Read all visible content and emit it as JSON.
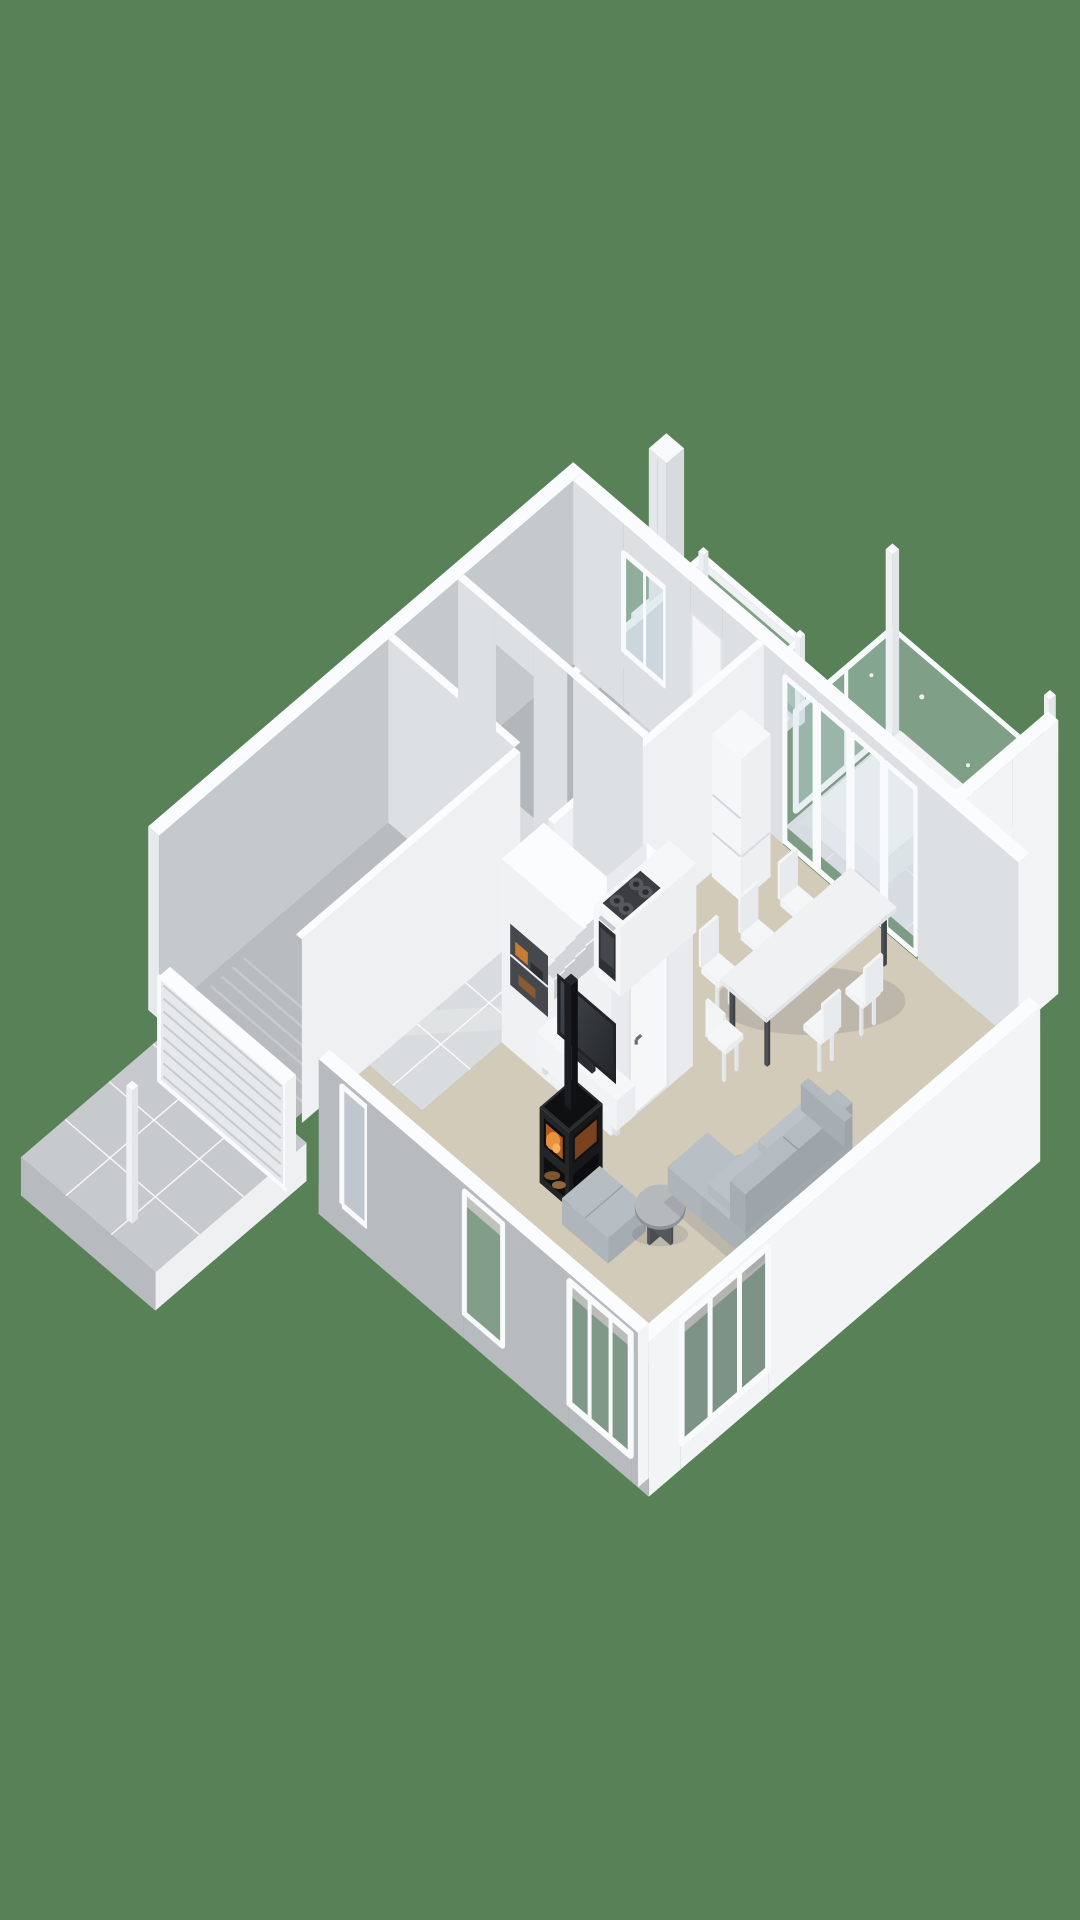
{
  "scene": {
    "type": "isometric-3d-floorplan-render",
    "background_color": "#588157",
    "colors": {
      "wallTop": "#fbfcfd",
      "ext": "#f2f4f6",
      "extSoft": "#eef0f2",
      "faceL": "#e7eaec",
      "grayExt": "#b7bbbf",
      "innerGray": "#c4c9ce",
      "innerLight": "#dde0e3",
      "innerMid": "#cfd3d7",
      "garageFloor": "#b8bcc1",
      "bedroomFloor": "#b2b7bc",
      "tile": "#d9dcde",
      "grout": "rgba(255,255,255,0.85)",
      "carpet": "#d2cbba",
      "terraceFloor": "#dcdee0",
      "driveFloor": "#c7cacd",
      "glass": "#c9dbe3",
      "frame": "#f8fafb",
      "blockL": "#eff1f3",
      "blockF": "#e8eaed",
      "white": "#f4f6f7",
      "whiteF": "#edeff1",
      "tread": "#d3d6d9",
      "riser": "#c5c9cc",
      "dark": "#2e3134",
      "steel": "#c3c8cc",
      "stoveBody": "#1c1e20",
      "stoveSide": "#232527",
      "fire": "#e8913f",
      "fireDeep": "#b35a22",
      "wood": "#8a5a33",
      "sofa": "#a9b1b7",
      "sofaTop": "#b8bfc5",
      "cushion": "#bcc3c8",
      "tvDark": "#212427",
      "screen": "#363a3e",
      "tableTop": "#eff1f2",
      "legDark": "#4b4e52",
      "chair": "#f2f4f5",
      "niche": "#45484c",
      "shadow": "rgba(70,76,82,0.15)"
    },
    "rooms": [
      {
        "name": "garage"
      },
      {
        "name": "entry-hall"
      },
      {
        "name": "bedroom"
      },
      {
        "name": "bathroom-hall"
      },
      {
        "name": "kitchen"
      },
      {
        "name": "dining-area"
      },
      {
        "name": "living-room"
      },
      {
        "name": "staircase"
      },
      {
        "name": "balcony"
      },
      {
        "name": "terrace"
      },
      {
        "name": "driveway"
      }
    ],
    "objects": [
      {
        "name": "garage-door",
        "style": "slatted-sectional"
      },
      {
        "name": "fence-post-driveway"
      },
      {
        "name": "kitchen-counter"
      },
      {
        "name": "cooktop",
        "burners": 4
      },
      {
        "name": "oven"
      },
      {
        "name": "fridge"
      },
      {
        "name": "dining-table",
        "chairs": 6
      },
      {
        "name": "sliding-glass-doors",
        "panels": 4
      },
      {
        "name": "wood-stove",
        "fire_color": "#e8913f"
      },
      {
        "name": "stove-flue"
      },
      {
        "name": "tv"
      },
      {
        "name": "tv-console"
      },
      {
        "name": "ottoman"
      },
      {
        "name": "coffee-table",
        "shape": "round"
      },
      {
        "name": "sofa",
        "shape": "l-corner"
      },
      {
        "name": "stairs",
        "treads": 6
      },
      {
        "name": "shoe-niche"
      },
      {
        "name": "interior-door-under-stairs"
      },
      {
        "name": "balcony-glass-railing"
      },
      {
        "name": "terrace-glass-railing"
      },
      {
        "name": "terrace-platform-table"
      },
      {
        "name": "privacy-wall"
      },
      {
        "name": "chimney-column"
      },
      {
        "name": "bedroom-window"
      },
      {
        "name": "living-room-windows"
      }
    ]
  }
}
